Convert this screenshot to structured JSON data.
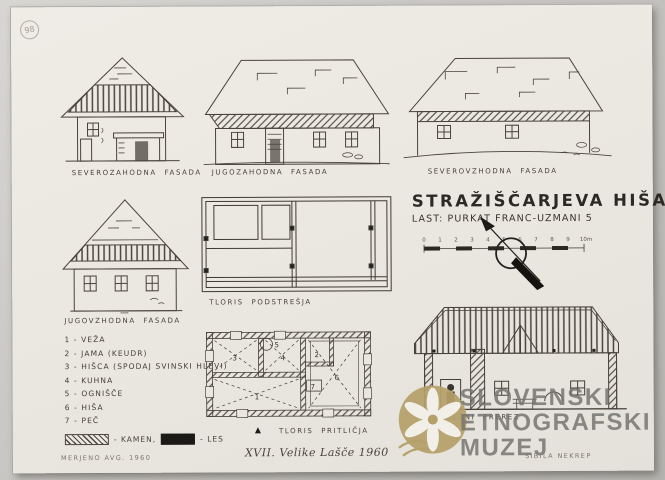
{
  "page": {
    "circled_number": "98"
  },
  "facades": {
    "nw": {
      "label": "SEVEROZAHODNA FASADA"
    },
    "sw": {
      "label": "JUGOZAHODNA FASADA"
    },
    "ne": {
      "label": "SEVEROVZHODNA FASADA"
    },
    "se": {
      "label": "JUGOVZHODNA FASADA"
    }
  },
  "plans": {
    "attic": {
      "label": "TLORIS PODSTREŠJA"
    },
    "ground": {
      "label": "TLORIS PRITLIČJA",
      "north_symbol": "▲",
      "rooms": [
        "1",
        "2",
        "3",
        "4",
        "5",
        "6",
        "7"
      ]
    },
    "section": {
      "label": "PODOLŽNI PREREZ"
    }
  },
  "title_block": {
    "title": "STRAŽIŠČARJEVA HIŠA",
    "subtitle": "LAST: PURKAT FRANC-UZMANI 5",
    "scale_ticks": [
      "0",
      "1",
      "2",
      "3",
      "4",
      "5",
      "6",
      "7",
      "8",
      "9",
      "10m"
    ]
  },
  "legend": {
    "items": [
      "1 - VEŽA",
      "2 - JAMA (KEUDR)",
      "3 - HIŠCA (SPODAJ SVINSKI HLEVI)",
      "4 - KUHNA",
      "5 - OGNIŠČE",
      "6 - HIŠA",
      "7 - PEČ"
    ],
    "materials": {
      "stone_label": "- KAMEN,",
      "wood_label": "- LES"
    }
  },
  "watermark": {
    "lines": [
      "SLOVENSKI",
      "ETNOGRAFSKI",
      "MUZEJ"
    ]
  },
  "footer": {
    "measured": "MERJENO AVG. 1960",
    "series": "XVII. Velike Lašče 1960",
    "drawn_by": "SIBILA NEKREP"
  },
  "colors": {
    "paper": "#eae7e0",
    "ink": "#49433b",
    "logo_gold": "#b5a069",
    "watermark_gray": "#767471"
  }
}
